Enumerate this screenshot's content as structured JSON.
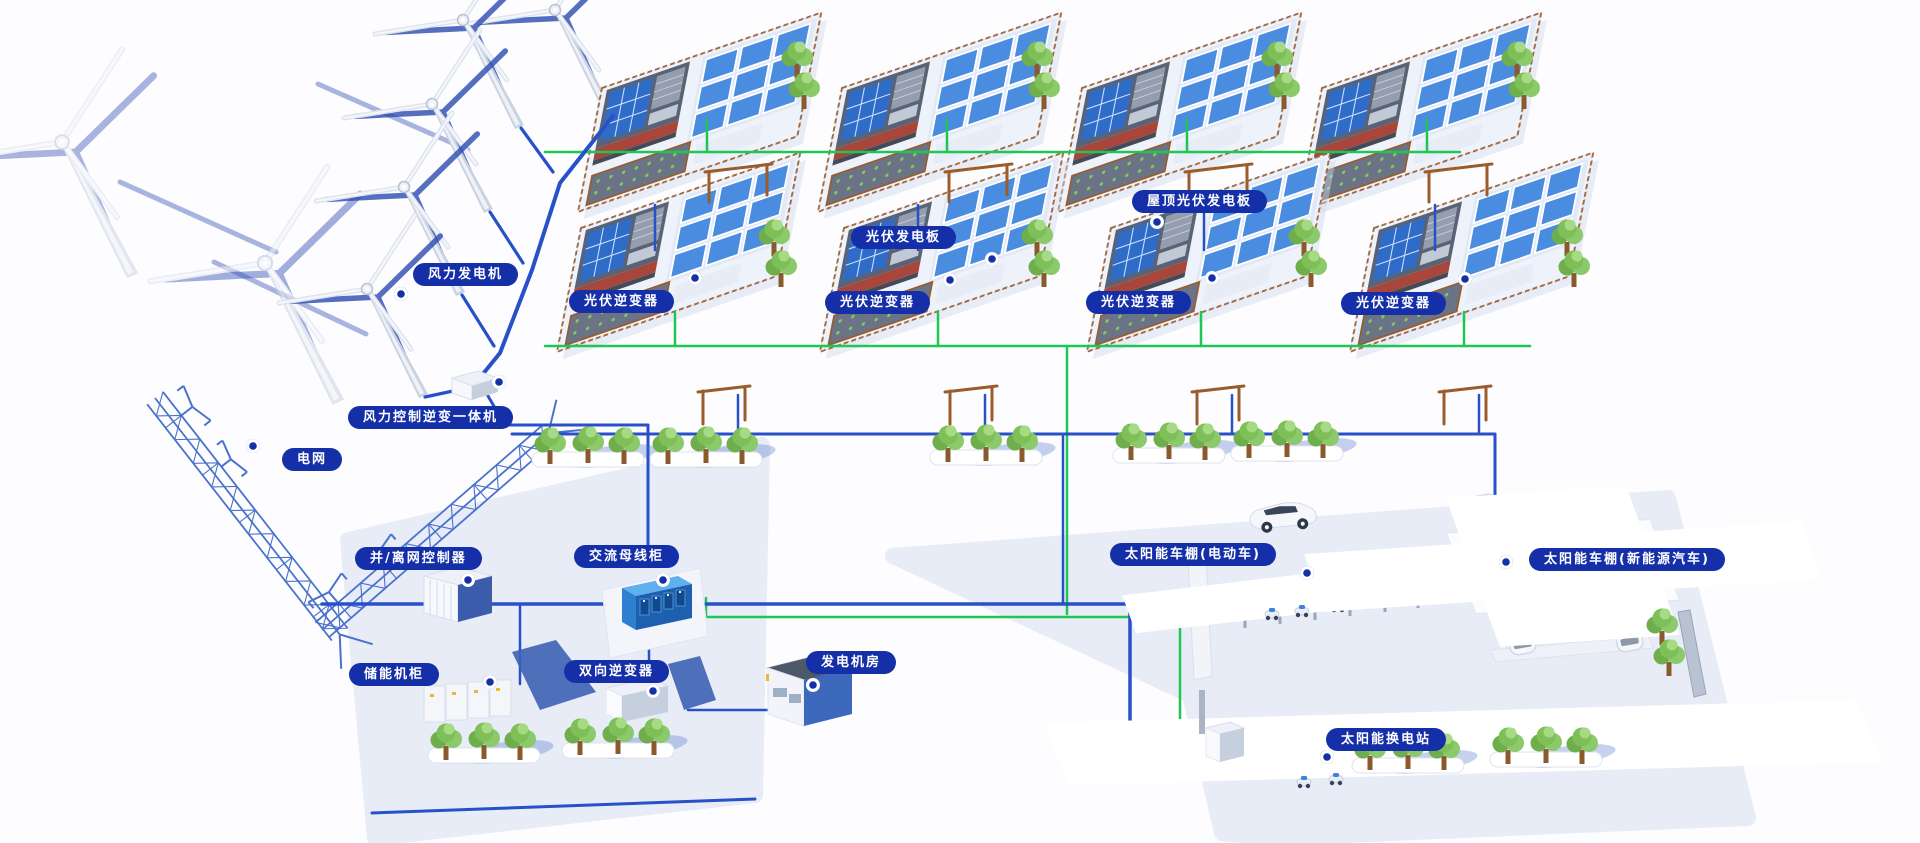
{
  "labels": {
    "wind_turbine": "风力发电机",
    "wind_control_inverter": "风力控制逆变一体机",
    "power_grid": "电网",
    "pv_inverter": "光伏逆变器",
    "pv_panel": "光伏发电板",
    "roof_pv_panel": "屋顶光伏发电板",
    "on_off_grid_controller": "并/离网控制器",
    "ac_busbar_cabinet": "交流母线柜",
    "energy_storage_cabinet": "储能机柜",
    "bidirectional_inverter": "双向逆变器",
    "generator_room": "发电机房",
    "solar_carport_ev": "太阳能车棚(电动车)",
    "solar_carport_nev": "太阳能车棚(新能源汽车)",
    "solar_swap_station": "太阳能换电站"
  },
  "colors": {
    "callout_bg": "#152fa8",
    "callout_text": "#ffffff",
    "line_blue": "#2850c8",
    "line_green": "#1ec653",
    "panel_blue": "#3f82dc",
    "roof_gray": "#5a6375",
    "house_red": "#a8463c",
    "tree_green": "#7fbf57",
    "platform_tint": "#e8ecf7",
    "shadow_blue": "#2b4ab0",
    "fence_brown": "#9a5c2b"
  }
}
